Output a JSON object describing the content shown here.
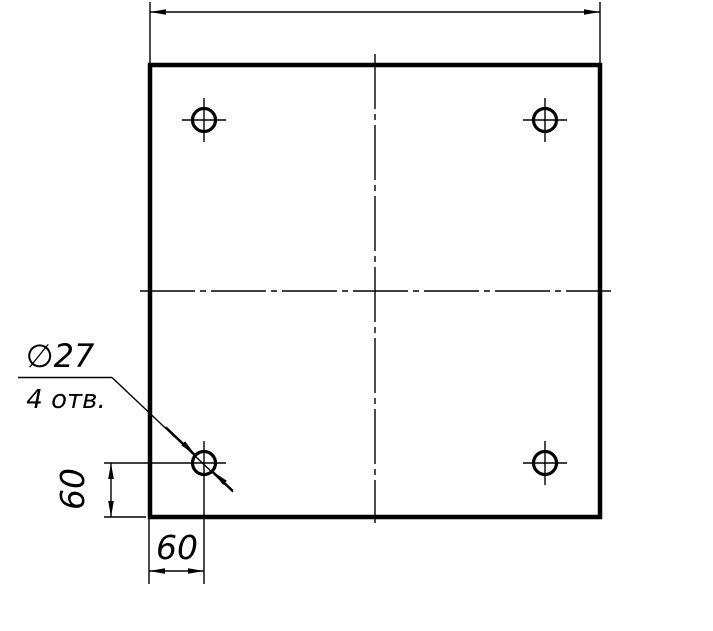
{
  "drawing": {
    "background": "#ffffff",
    "line_color": "#000000",
    "callout": {
      "diameter": "∅27",
      "count": "4 отв."
    },
    "dims": {
      "hole_offset_vertical": "60",
      "hole_offset_horizontal": "60"
    }
  }
}
